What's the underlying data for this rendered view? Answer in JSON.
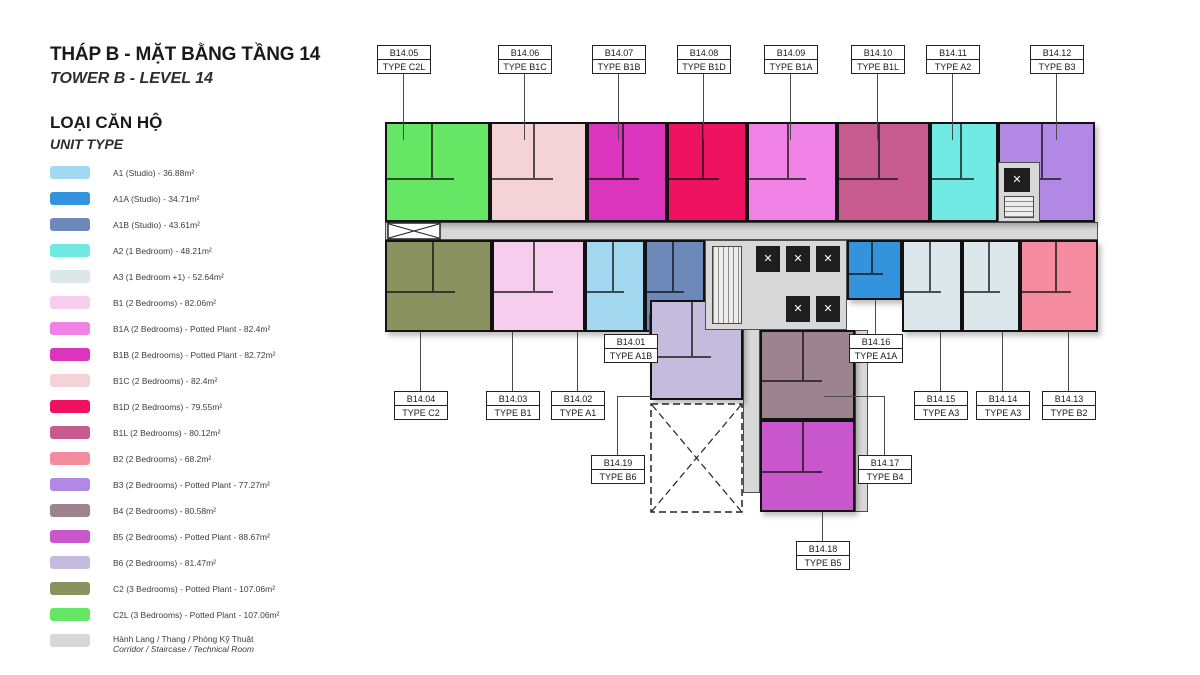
{
  "header": {
    "title_vi": "THÁP B - MẶT BẰNG TẦNG 14",
    "title_en": "TOWER B - LEVEL 14"
  },
  "legend": {
    "title_vi": "LOẠI CĂN HỘ",
    "title_en": "UNIT TYPE",
    "items": [
      {
        "key": "A1",
        "label": "A1 (Studio) - 36.88m²"
      },
      {
        "key": "A1A",
        "label": "A1A (Studio) - 34.71m²"
      },
      {
        "key": "A1B",
        "label": "A1B (Studio) - 43.61m²"
      },
      {
        "key": "A2",
        "label": "A2 (1 Bedroom) - 48.21m²"
      },
      {
        "key": "A3",
        "label": "A3 (1 Bedroom +1) - 52.64m²"
      },
      {
        "key": "B1",
        "label": "B1 (2 Bedrooms) - 82.06m²"
      },
      {
        "key": "B1A",
        "label": "B1A (2 Bedrooms) - Potted Plant - 82.4m²"
      },
      {
        "key": "B1B",
        "label": "B1B (2 Bedrooms) - Potted Plant - 82.72m²"
      },
      {
        "key": "B1C",
        "label": "B1C (2 Bedrooms) - 82.4m²"
      },
      {
        "key": "B1D",
        "label": "B1D (2 Bedrooms) - 79.55m²"
      },
      {
        "key": "B1L",
        "label": "B1L (2 Bedrooms) - 80.12m²"
      },
      {
        "key": "B2",
        "label": "B2 (2 Bedrooms) - 68.2m²"
      },
      {
        "key": "B3",
        "label": "B3 (2 Bedrooms) - Potted Plant - 77.27m²"
      },
      {
        "key": "B4",
        "label": "B4 (2 Bedrooms) - 80.58m²"
      },
      {
        "key": "B5",
        "label": "B5 (2 Bedrooms) - Potted Plant - 88.67m²"
      },
      {
        "key": "B6",
        "label": "B6 (2 Bedrooms) - 81.47m²"
      },
      {
        "key": "C2",
        "label": "C2 (3 Bedrooms) - Potted Plant - 107.06m²"
      },
      {
        "key": "C2L",
        "label": "C2L (3 Bedrooms) - Potted Plant - 107.06m²"
      },
      {
        "key": "CORR",
        "label": "Hành Lang / Thang / Phòng Kỹ Thuật",
        "label2": "Corridor / Staircase / Technical Room"
      }
    ]
  },
  "colors": {
    "A1": "#a2d9f0",
    "A1A": "#3394dd",
    "A1B": "#6d89b9",
    "A2": "#6fe9e2",
    "A3": "#dbe7ea",
    "B1": "#f7cdee",
    "B1A": "#ef82e4",
    "B1B": "#dc35bd",
    "B1C": "#f3d3d6",
    "B1D": "#ee1260",
    "B1L": "#c75a8e",
    "B2": "#f48b9e",
    "B3": "#b189e4",
    "B4": "#9d8290",
    "B5": "#c757ca",
    "B6": "#c5bbdc",
    "C2": "#8a925f",
    "C2L": "#65e765",
    "CORR": "#d8d8d8"
  },
  "plan": {
    "units": [
      {
        "id": "B14.05",
        "type": "TYPE C2L",
        "key": "C2L"
      },
      {
        "id": "B14.06",
        "type": "TYPE B1C",
        "key": "B1C"
      },
      {
        "id": "B14.07",
        "type": "TYPE B1B",
        "key": "B1B"
      },
      {
        "id": "B14.08",
        "type": "TYPE B1D",
        "key": "B1D"
      },
      {
        "id": "B14.09",
        "type": "TYPE B1A",
        "key": "B1A"
      },
      {
        "id": "B14.10",
        "type": "TYPE B1L",
        "key": "B1L"
      },
      {
        "id": "B14.11",
        "type": "TYPE A2",
        "key": "A2"
      },
      {
        "id": "B14.12",
        "type": "TYPE B3",
        "key": "B3"
      },
      {
        "id": "B14.04",
        "type": "TYPE C2",
        "key": "C2"
      },
      {
        "id": "B14.03",
        "type": "TYPE B1",
        "key": "B1"
      },
      {
        "id": "B14.02",
        "type": "TYPE A1",
        "key": "A1"
      },
      {
        "id": "B14.15",
        "type": "TYPE A3",
        "key": "A3"
      },
      {
        "id": "B14.14",
        "type": "TYPE A3",
        "key": "A3"
      },
      {
        "id": "B14.13",
        "type": "TYPE B2",
        "key": "B2"
      },
      {
        "id": "B14.01",
        "type": "TYPE A1B",
        "key": "A1B"
      },
      {
        "id": "B14.16",
        "type": "TYPE A1A",
        "key": "A1A"
      },
      {
        "id": "B14.19",
        "type": "TYPE B6",
        "key": "B6"
      },
      {
        "id": "B14.17",
        "type": "TYPE B4",
        "key": "B4"
      },
      {
        "id": "B14.18",
        "type": "TYPE B5",
        "key": "B5"
      }
    ]
  }
}
